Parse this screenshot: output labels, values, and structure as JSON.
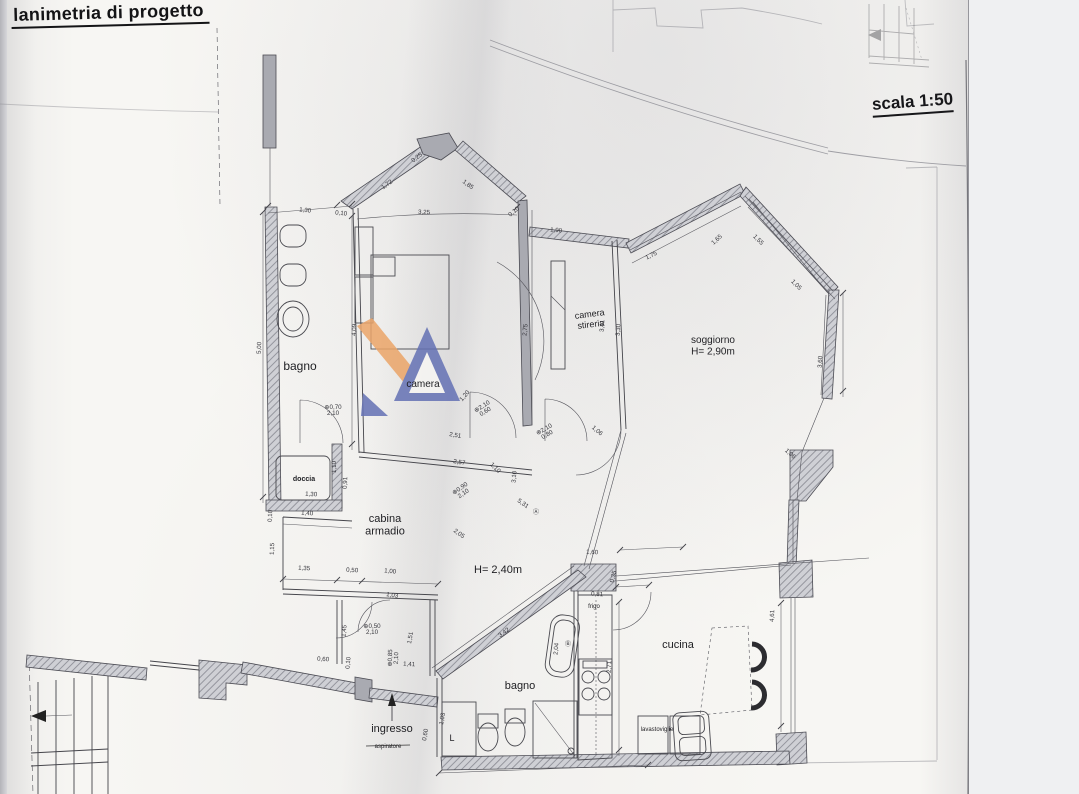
{
  "meta": {
    "title": "lanimetria di progetto",
    "scale_label": "scala 1:50"
  },
  "colors": {
    "wm_blue": "#6471b4",
    "wm_orange": "#eba568",
    "ink": "#3f3f45"
  },
  "plan": {
    "rooms": [
      {
        "label": "bagno",
        "x": 300,
        "y": 370,
        "fs": 12
      },
      {
        "label": "camera",
        "x": 423,
        "y": 387,
        "fs": 10
      },
      {
        "label": "doccia",
        "x": 304,
        "y": 481,
        "fs": 7,
        "bold": true
      },
      {
        "label": "cabina|armadio",
        "x": 385,
        "y": 522,
        "fs": 11
      },
      {
        "label": "camera|stireria",
        "x": 590,
        "y": 317,
        "fs": 9,
        "rot": -7
      },
      {
        "label": "soggiorno|H= 2,90m",
        "x": 713,
        "y": 343,
        "fs": 10
      },
      {
        "label": "cucina",
        "x": 678,
        "y": 648,
        "fs": 11
      },
      {
        "label": "bagno",
        "x": 520,
        "y": 689,
        "fs": 11
      },
      {
        "label": "ingresso",
        "x": 392,
        "y": 732,
        "fs": 11
      },
      {
        "label": "H= 2,40m",
        "x": 498,
        "y": 573,
        "fs": 11
      },
      {
        "label": "L",
        "x": 452,
        "y": 741,
        "fs": 9
      },
      {
        "label": "frigo",
        "x": 594,
        "y": 608,
        "fs": 6
      },
      {
        "label": "lavastoviglie",
        "x": 657,
        "y": 731,
        "fs": 6
      },
      {
        "label": "aspiratore",
        "x": 388,
        "y": 748,
        "fs": 6,
        "strike": true
      }
    ],
    "dims": [
      {
        "t": "1,30",
        "x": 305,
        "y": 212,
        "r": 6
      },
      {
        "t": "0,10",
        "x": 341,
        "y": 215,
        "r": 6
      },
      {
        "t": "3,25",
        "x": 424,
        "y": 214,
        "r": 2
      },
      {
        "t": "0,25",
        "x": 418,
        "y": 159,
        "r": -38
      },
      {
        "t": "1,72",
        "x": 388,
        "y": 186,
        "r": -36
      },
      {
        "t": "1,85",
        "x": 467,
        "y": 186,
        "r": 37
      },
      {
        "t": "0,10",
        "x": 515,
        "y": 213,
        "r": -40
      },
      {
        "t": "5,00",
        "x": 261,
        "y": 348,
        "r": -88
      },
      {
        "t": "4,09",
        "x": 356,
        "y": 330,
        "r": -88
      },
      {
        "t": "0,70",
        "t2": "2,10",
        "x": 333,
        "y": 409,
        "c": true
      },
      {
        "t": "1,10",
        "x": 336,
        "y": 467,
        "r": -90
      },
      {
        "t": "1,30",
        "x": 311,
        "y": 496,
        "r": 4
      },
      {
        "t": "2,51",
        "x": 455,
        "y": 437,
        "r": 9
      },
      {
        "t": "2,57",
        "x": 459,
        "y": 464,
        "r": 9
      },
      {
        "t": "0,91",
        "x": 347,
        "y": 483,
        "r": -88
      },
      {
        "t": "0,10",
        "x": 272,
        "y": 516,
        "r": -88
      },
      {
        "t": "1,40",
        "x": 307,
        "y": 515,
        "r": 4
      },
      {
        "t": "1,15",
        "x": 274,
        "y": 549,
        "r": -88
      },
      {
        "t": "1,35",
        "x": 304,
        "y": 570,
        "r": 4
      },
      {
        "t": "0,50",
        "x": 352,
        "y": 572,
        "r": 4
      },
      {
        "t": "1,00",
        "x": 390,
        "y": 573,
        "r": 6
      },
      {
        "t": "1,03",
        "x": 392,
        "y": 597,
        "r": 9
      },
      {
        "t": "2,05",
        "x": 458,
        "y": 535,
        "r": 36
      },
      {
        "t": "1,20",
        "x": 466,
        "y": 397,
        "r": -50
      },
      {
        "t": "2,10",
        "t2": "0,60",
        "x": 483,
        "y": 408,
        "r": -32,
        "c": true
      },
      {
        "t": "0,90",
        "t2": "2,10",
        "x": 461,
        "y": 490,
        "r": -35,
        "c": true
      },
      {
        "t": "1,10",
        "x": 494,
        "y": 469,
        "r": 45
      },
      {
        "t": "5,31",
        "x": 522,
        "y": 505,
        "r": 35
      },
      {
        "t": "3,10",
        "x": 516,
        "y": 477,
        "r": -85
      },
      {
        "t": "Ⓐ",
        "x": 536,
        "y": 514
      },
      {
        "t": "2,10",
        "t2": "0,80",
        "x": 545,
        "y": 431,
        "r": -30,
        "c": true
      },
      {
        "t": "1,06",
        "x": 596,
        "y": 432,
        "r": 40
      },
      {
        "t": "1,90",
        "x": 556,
        "y": 232,
        "r": 5
      },
      {
        "t": "2,75",
        "x": 527,
        "y": 330,
        "r": -85
      },
      {
        "t": "3,41",
        "x": 604,
        "y": 326,
        "r": -87
      },
      {
        "t": "3,30",
        "x": 620,
        "y": 330,
        "r": -87
      },
      {
        "t": "1,75",
        "x": 652,
        "y": 257,
        "r": -26
      },
      {
        "t": "1,65",
        "x": 718,
        "y": 241,
        "r": -42
      },
      {
        "t": "1,55",
        "x": 757,
        "y": 241,
        "r": 45
      },
      {
        "t": "1,05",
        "x": 795,
        "y": 286,
        "r": 45
      },
      {
        "t": "3,60",
        "x": 822,
        "y": 362,
        "r": -87
      },
      {
        "t": "1,06",
        "x": 789,
        "y": 455,
        "r": 42
      },
      {
        "t": "4,61",
        "x": 774,
        "y": 616,
        "r": -88
      },
      {
        "t": "1,60",
        "x": 592,
        "y": 554,
        "r": 3
      },
      {
        "t": "0,35",
        "x": 615,
        "y": 577,
        "r": -75
      },
      {
        "t": "0,81",
        "x": 597,
        "y": 596,
        "r": 3
      },
      {
        "t": "2,71",
        "x": 611,
        "y": 667,
        "r": -88
      },
      {
        "t": "2,04",
        "x": 558,
        "y": 649,
        "r": -85
      },
      {
        "t": "Ⓑ",
        "x": 568,
        "y": 646
      },
      {
        "t": "3,42",
        "x": 505,
        "y": 634,
        "r": -36
      },
      {
        "t": "1,45",
        "x": 346,
        "y": 631,
        "r": -85
      },
      {
        "t": "0,50",
        "t2": "2,10",
        "x": 372,
        "y": 628,
        "c": true
      },
      {
        "t": "1,51",
        "x": 412,
        "y": 638,
        "r": -80
      },
      {
        "t": "0,85",
        "t2": "2,10",
        "x": 392,
        "y": 658,
        "r": -88,
        "c": true
      },
      {
        "t": "1,41",
        "x": 409,
        "y": 666,
        "r": 3
      },
      {
        "t": "0,60",
        "x": 427,
        "y": 735,
        "r": -80
      },
      {
        "t": "1,03",
        "x": 444,
        "y": 719,
        "r": -80
      },
      {
        "t": "0,60",
        "x": 323,
        "y": 661,
        "r": 3
      },
      {
        "t": "0,10",
        "x": 350,
        "y": 663,
        "r": -85
      }
    ]
  }
}
